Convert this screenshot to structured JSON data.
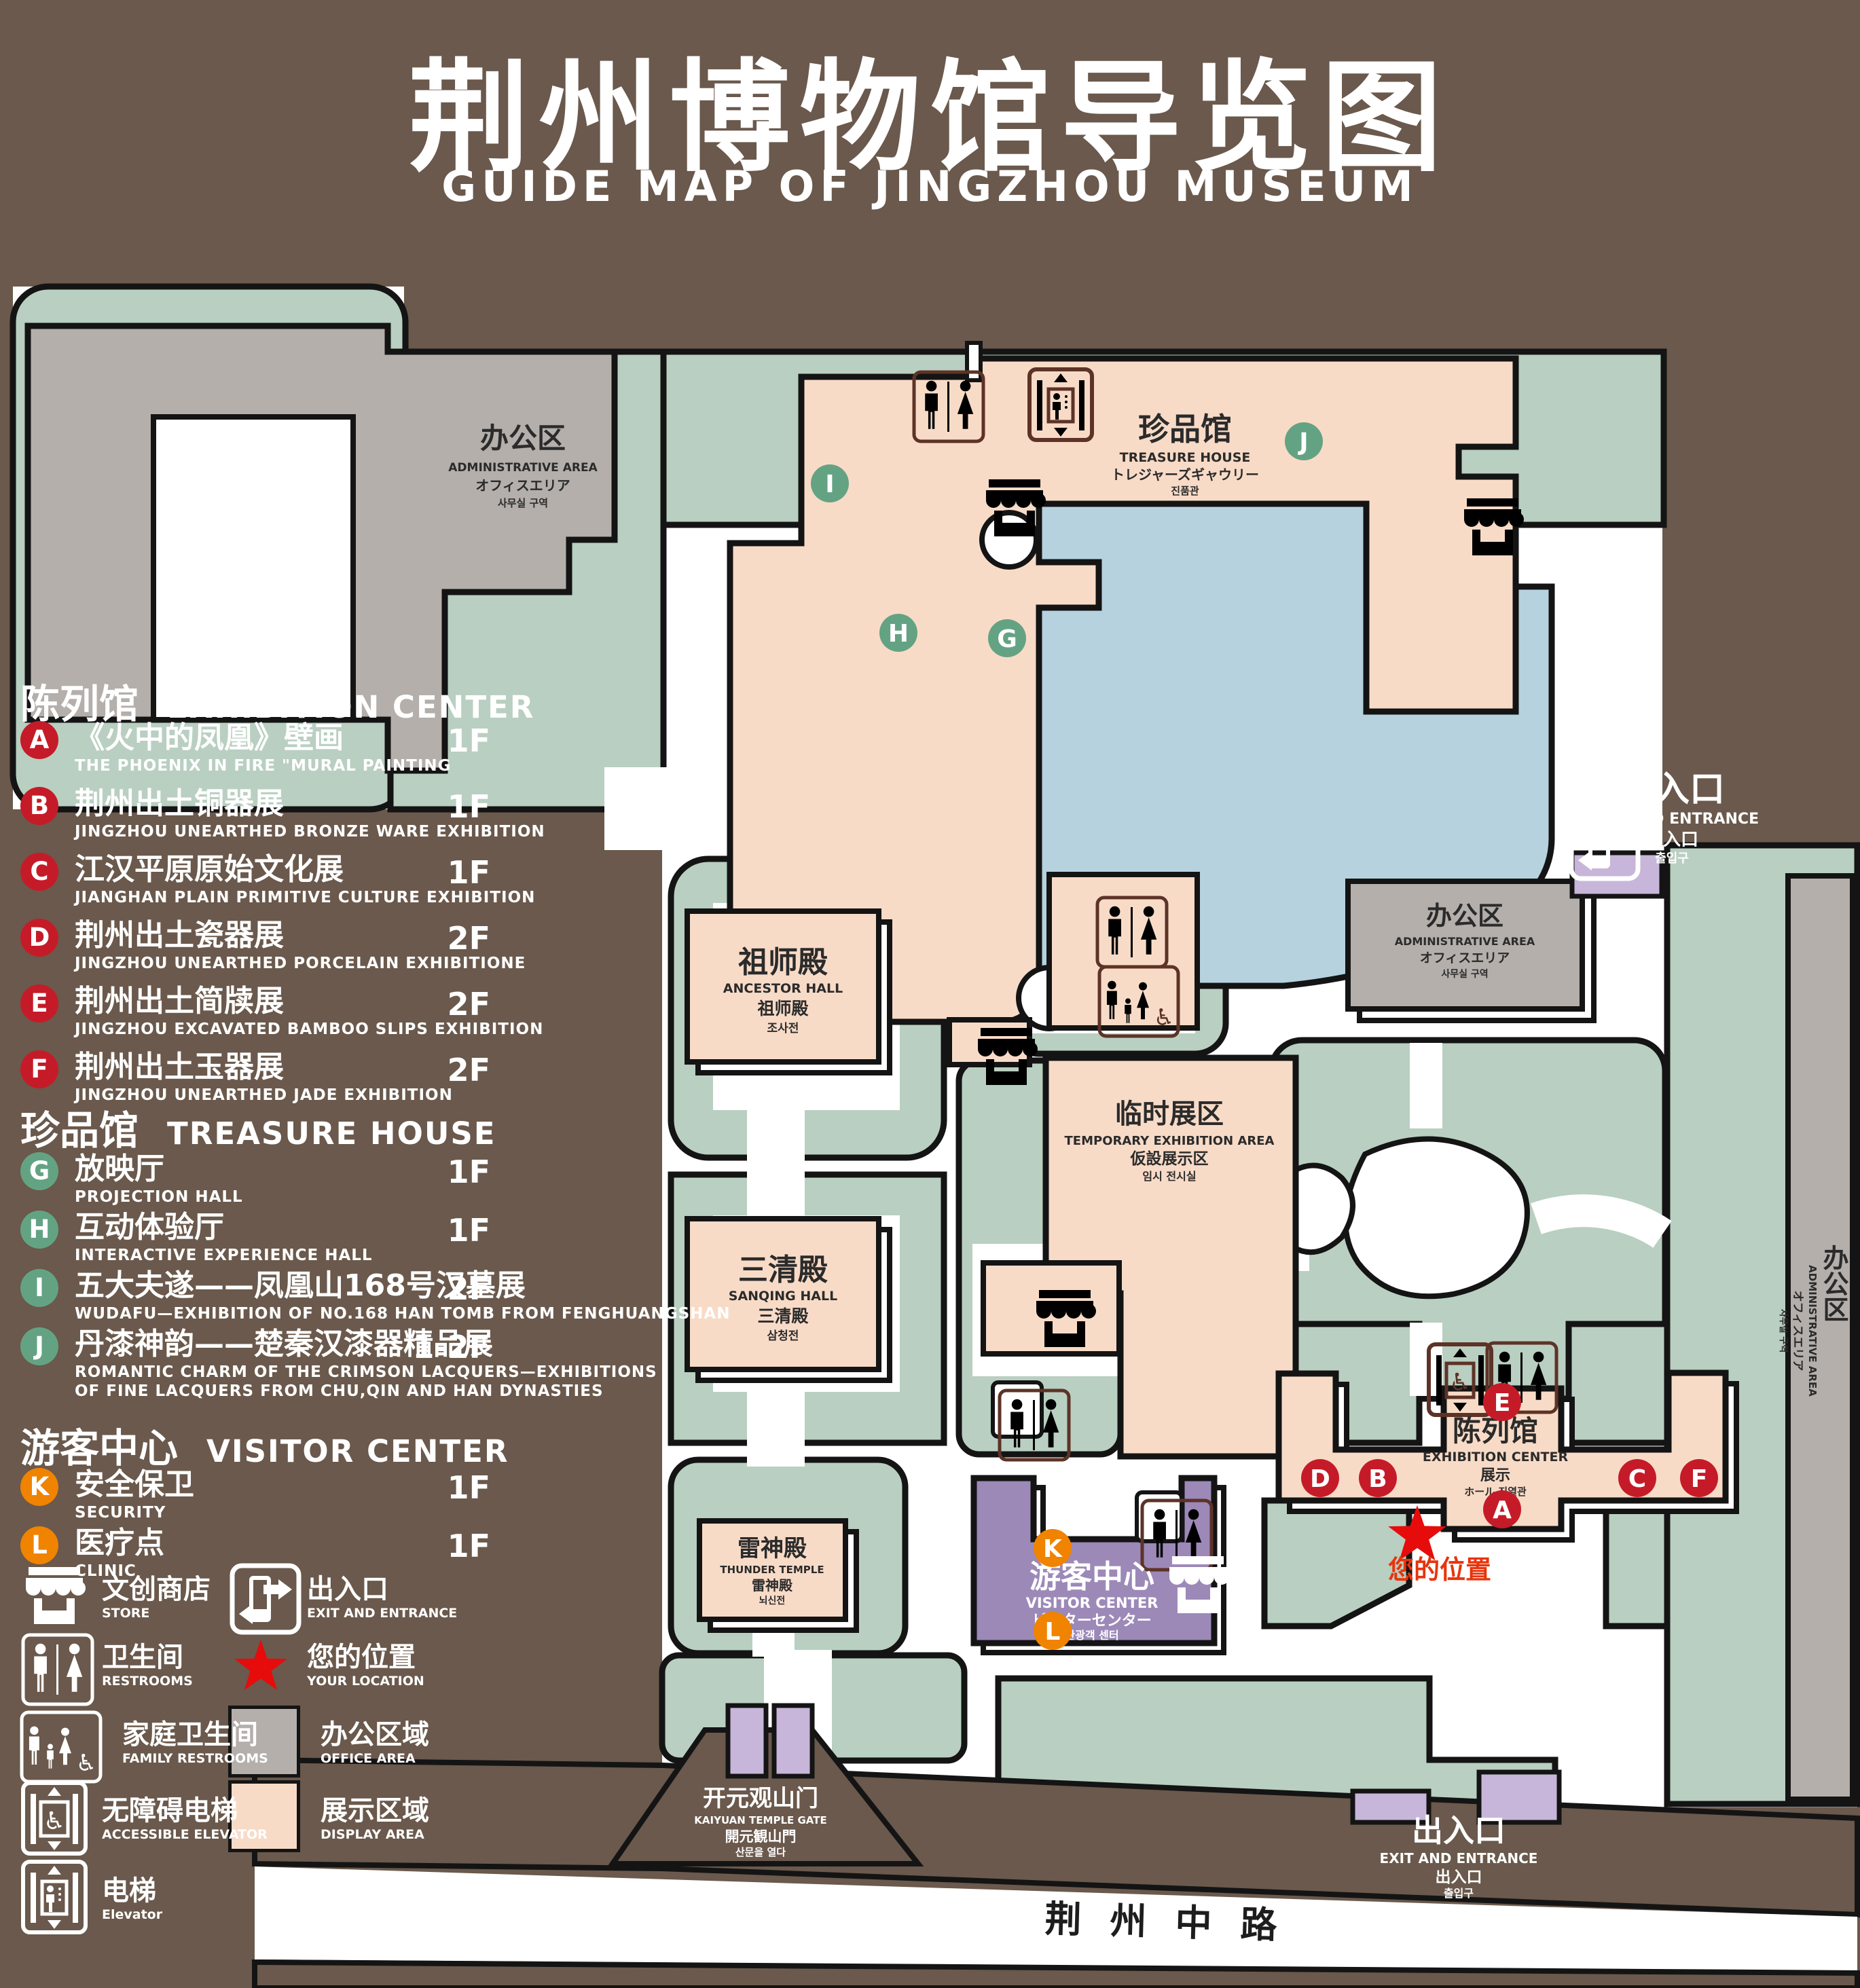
{
  "title": {
    "zh": "荆州博物馆导览图",
    "en": "GUIDE MAP OF JINGZHOU MUSEUM"
  },
  "colors": {
    "background": "#6a594c",
    "green": "#b9cfc1",
    "peach": "#f8dbc7",
    "gray": "#b4afab",
    "lake_blue": "#b6d2de",
    "purple": "#9c89b8",
    "light_purple": "#c7b6d9",
    "badge_red": "#c51b28",
    "badge_green": "#63a383",
    "badge_orange": "#f08300",
    "icon_brown": "#5d3327",
    "star_red": "#e60c0c"
  },
  "legend": {
    "sections": [
      {
        "zh": "陈列馆",
        "en": "EXHIBITION CENTER",
        "items": [
          {
            "letter": "A",
            "zh": "《火中的凤凰》壁画",
            "en": "THE PHOENIX IN FIRE \"MURAL PAINTING",
            "floor": "1F"
          },
          {
            "letter": "B",
            "zh": "荆州出土铜器展",
            "en": "JINGZHOU UNEARTHED BRONZE WARE EXHIBITION",
            "floor": "1F"
          },
          {
            "letter": "C",
            "zh": "江汉平原原始文化展",
            "en": "JIANGHAN PLAIN PRIMITIVE CULTURE EXHIBITION",
            "floor": "1F"
          },
          {
            "letter": "D",
            "zh": "荆州出土瓷器展",
            "en": "JINGZHOU UNEARTHED PORCELAIN EXHIBITIONE",
            "floor": "2F"
          },
          {
            "letter": "E",
            "zh": "荆州出土简牍展",
            "en": "JINGZHOU EXCAVATED BAMBOO SLIPS EXHIBITION",
            "floor": "2F"
          },
          {
            "letter": "F",
            "zh": "荆州出土玉器展",
            "en": "JINGZHOU UNEARTHED JADE EXHIBITION",
            "floor": "2F"
          }
        ]
      },
      {
        "zh": "珍品馆",
        "en": "TREASURE HOUSE",
        "items": [
          {
            "letter": "G",
            "zh": "放映厅",
            "en": "PROJECTION HALL",
            "floor": "1F"
          },
          {
            "letter": "H",
            "zh": "互动体验厅",
            "en": "INTERACTIVE EXPERIENCE HALL",
            "floor": "1F"
          },
          {
            "letter": "I",
            "zh": "五大夫遂——凤凰山168号汉墓展",
            "en": "WUDAFU—EXHIBITION OF NO.168 HAN TOMB FROM FENGHUANGSHAN",
            "floor": "2F"
          },
          {
            "letter": "J",
            "zh": "丹漆神韵——楚秦汉漆器精品展",
            "en": "ROMANTIC CHARM OF THE CRIMSON LACQUERS—EXHIBITIONS",
            "en2": "OF FINE LACQUERS FROM CHU,QIN AND HAN DYNASTIES",
            "floor": "1-2F"
          }
        ]
      },
      {
        "zh": "游客中心",
        "en": "VISITOR CENTER",
        "items": [
          {
            "letter": "K",
            "zh": "安全保卫",
            "en": "SECURITY",
            "floor": "1F"
          },
          {
            "letter": "L",
            "zh": "医疗点",
            "en": "CLINIC",
            "floor": "1F"
          }
        ]
      }
    ],
    "symbols": [
      {
        "zh": "文创商店",
        "en": "STORE"
      },
      {
        "zh": "出入口",
        "en": "EXIT AND ENTRANCE"
      },
      {
        "zh": "卫生间",
        "en": "RESTROOMS"
      },
      {
        "zh": "您的位置",
        "en": "YOUR LOCATION"
      },
      {
        "zh": "家庭卫生间",
        "en": "FAMILY RESTROOMS"
      },
      {
        "zh": "办公区域",
        "en": "OFFICE AREA"
      },
      {
        "zh": "无障碍电梯",
        "en": "ACCESSIBLE ELEVATOR"
      },
      {
        "zh": "展示区域",
        "en": "DISPLAY AREA"
      },
      {
        "zh": "电梯",
        "en": "Elevator"
      }
    ]
  },
  "map": {
    "admin_area": {
      "zh": "办公区",
      "en": "ADMINISTRATIVE AREA",
      "ja": "オフィスエリア",
      "ko": "사무실 구역"
    },
    "treasure_house": {
      "zh": "珍品馆",
      "en": "TREASURE HOUSE",
      "ja": "トレジャーズギャウリー",
      "ko": "진품관"
    },
    "ancestor_hall": {
      "zh": "祖师殿",
      "en": "ANCESTOR HALL",
      "zh2": "祖师殿",
      "ko": "조사전"
    },
    "sanqing_hall": {
      "zh": "三清殿",
      "en": "SANQING HALL",
      "zh2": "三清殿",
      "ko": "삼청전"
    },
    "thunder_temple": {
      "zh": "雷神殿",
      "en": "THUNDER TEMPLE",
      "zh2": "雷神殿",
      "ko": "뇌신전"
    },
    "temporary_exhibition": {
      "zh": "临时展区",
      "en": "TEMPORARY EXHIBITION AREA",
      "ja": "仮設展示区",
      "ko": "임시 전시실"
    },
    "exhibition_center": {
      "zh": "陈列馆",
      "en": "EXHIBITION CENTER",
      "zh2": "展示",
      "jako": "ホール 진열관"
    },
    "visitor_center": {
      "zh": "游客中心",
      "en": "VISITOR CENTER",
      "ja": "ビジターセンター",
      "ko": "관광객 센터"
    },
    "exit_top": {
      "zh": "出入口",
      "en": "EXIT AND ENTRANCE",
      "zh2": "出入口",
      "ko": "출입구"
    },
    "exit_bottom": {
      "zh": "出入口",
      "en": "EXIT AND ENTRANCE",
      "zh2": "出入口",
      "ko": "출입구"
    },
    "gate": {
      "zh": "开元观山门",
      "en": "KAIYUAN TEMPLE GATE",
      "ja": "開元観山門",
      "ko": "산문을 열다"
    },
    "road": {
      "zh": "荆州中路"
    },
    "your_location": {
      "zh": "您的位置"
    },
    "markers": [
      {
        "letter": "A"
      },
      {
        "letter": "B"
      },
      {
        "letter": "C"
      },
      {
        "letter": "D"
      },
      {
        "letter": "E"
      },
      {
        "letter": "F"
      },
      {
        "letter": "G"
      },
      {
        "letter": "H"
      },
      {
        "letter": "I"
      },
      {
        "letter": "J"
      },
      {
        "letter": "K"
      },
      {
        "letter": "L"
      }
    ]
  }
}
